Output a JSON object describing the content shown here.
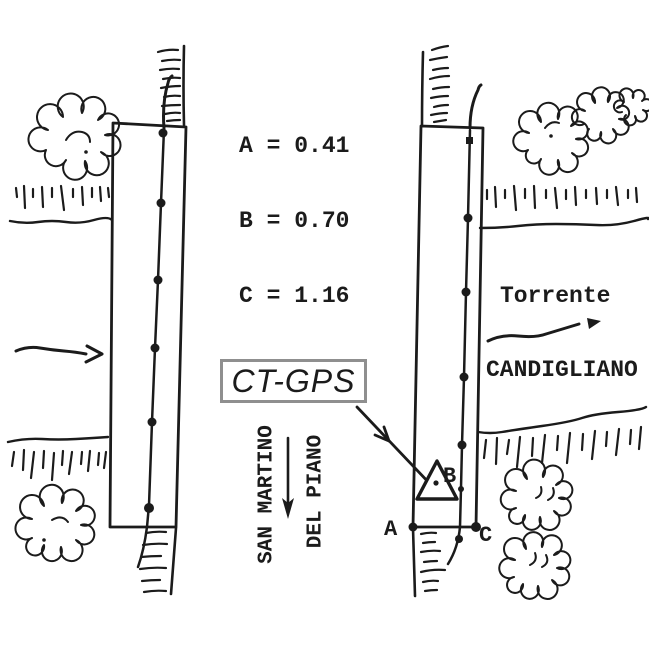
{
  "measurements": {
    "line_a": "A = 0.41",
    "line_b": "B = 0.70",
    "line_c": "C = 1.16"
  },
  "ct_gps": {
    "label": "CT-GPS"
  },
  "river": {
    "word1": "Torrente",
    "word2": "CANDIGLIANO"
  },
  "road": {
    "word1": "SAN MARTINO",
    "word2": "DEL PIANO"
  },
  "points": {
    "a": "A",
    "b": "B",
    "c": "C"
  },
  "colors": {
    "ink": "#1b1b1b",
    "box_border": "#8f8f8f",
    "background": "#ffffff"
  }
}
